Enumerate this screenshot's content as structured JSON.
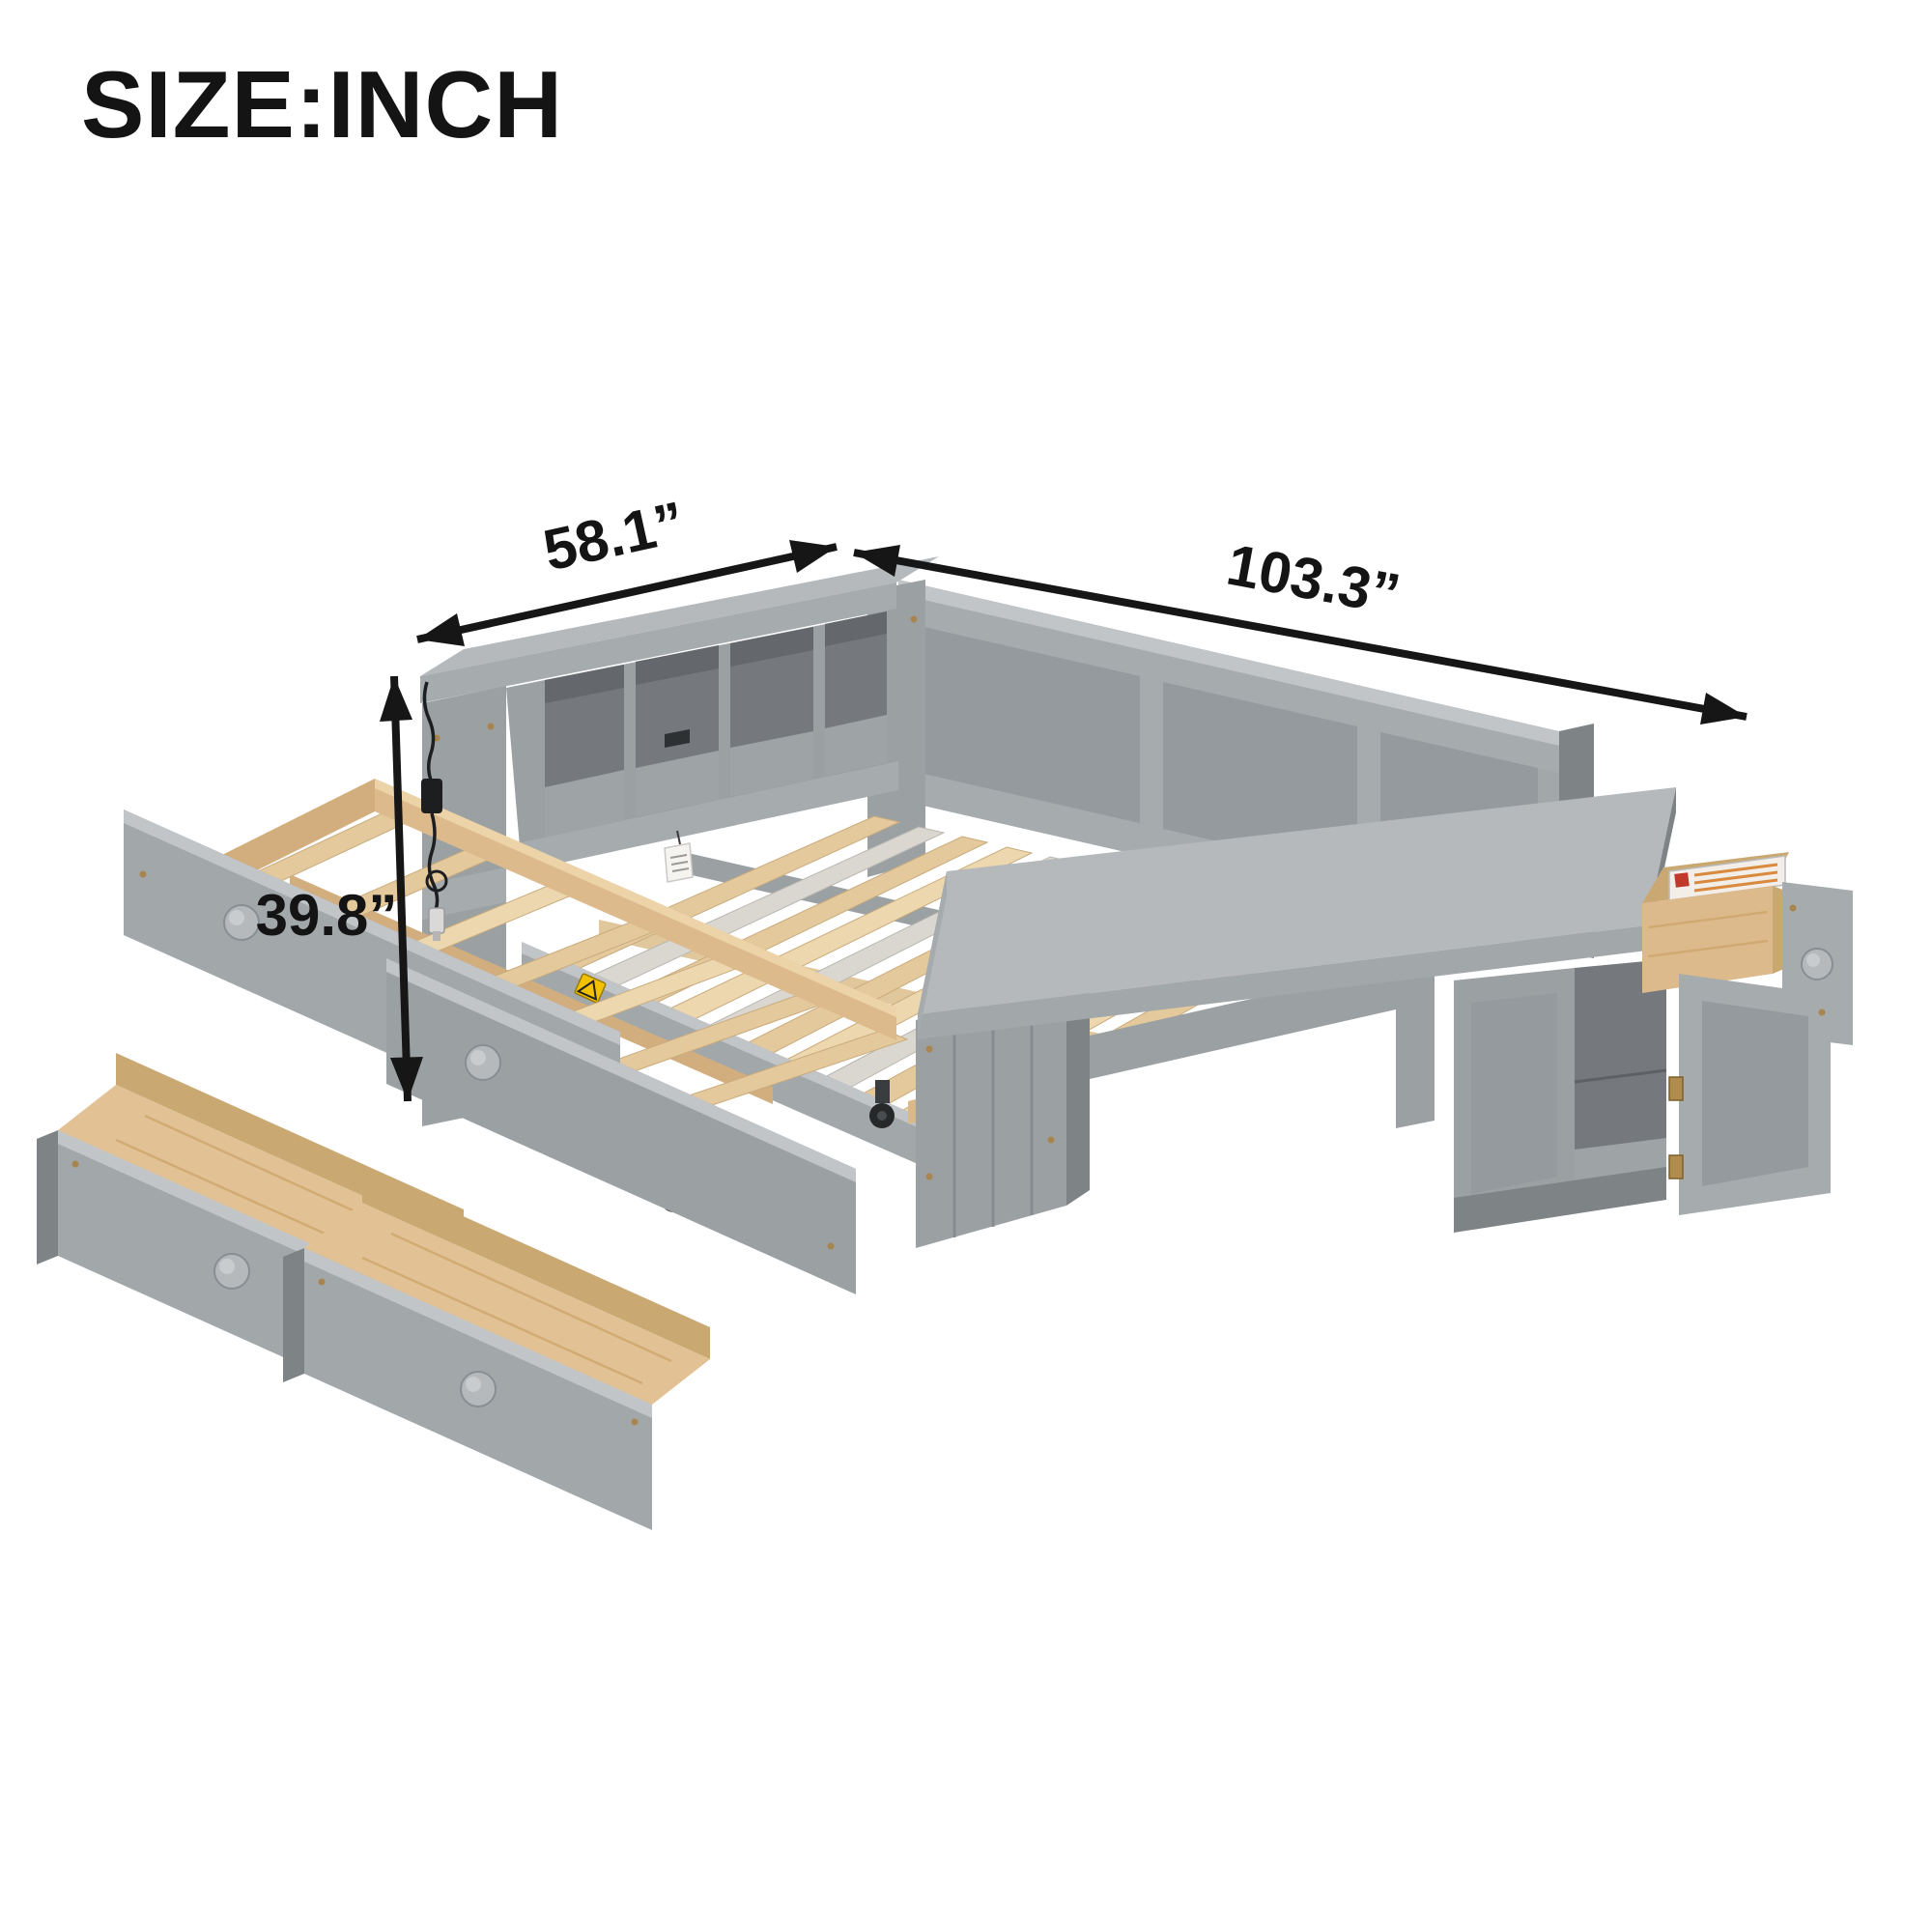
{
  "title": "SIZE:INCH",
  "dimensions": {
    "width": {
      "label": "58.1”"
    },
    "length": {
      "label": "103.3”"
    },
    "height": {
      "label": "39.8”"
    }
  },
  "icons": {
    "warning_sticker": "triangle-alert",
    "drawer_knob": "round-knob",
    "caster": "wheel"
  },
  "colors": {
    "background": "#ffffff",
    "text": "#141414",
    "arrow": "#161616",
    "furniture_gray_top": "#b6b9bb",
    "furniture_gray": "#9ba0a3",
    "furniture_gray_dark": "#75797d",
    "wood_slat": "#e4c99c",
    "wood_rail": "#dcba8c",
    "wood_dark": "#c9a872",
    "slat_pale": "#d9d7d0",
    "warning_yellow": "#f2c200",
    "label_red": "#c0392b",
    "hardware_bronze": "#a8854e",
    "cable_black": "#1c1e20"
  }
}
